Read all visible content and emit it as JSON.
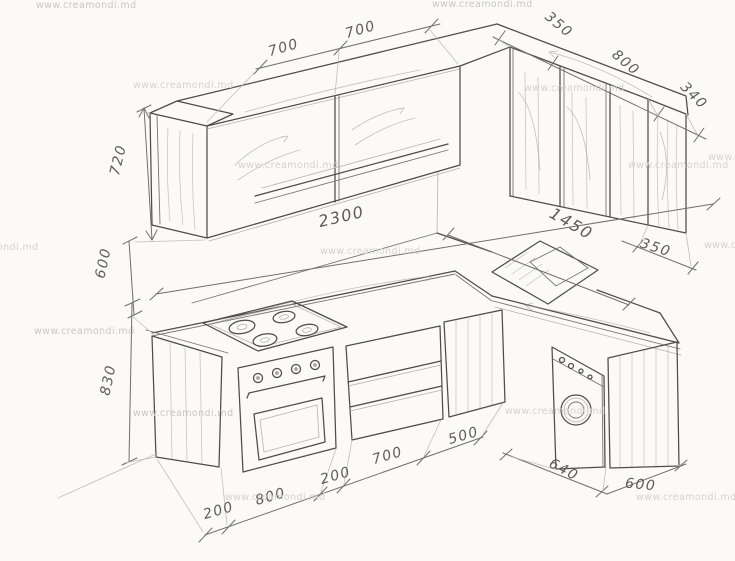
{
  "watermark": {
    "text": "www.creamondi.md"
  },
  "dims": {
    "upper_left_1": "700",
    "upper_left_2": "700",
    "upper_right_1": "350",
    "upper_right_2": "800",
    "upper_right_3": "340",
    "height_upper_cabinet": "720",
    "height_gap": "600",
    "height_base": "830",
    "total_length": "2300",
    "right_wall_length": "1450",
    "right_wall_end": "350",
    "base_1": "200",
    "base_2": "800",
    "base_3": "200",
    "base_4": "700",
    "base_5": "500",
    "right_base_1": "640",
    "right_base_2": "600"
  }
}
